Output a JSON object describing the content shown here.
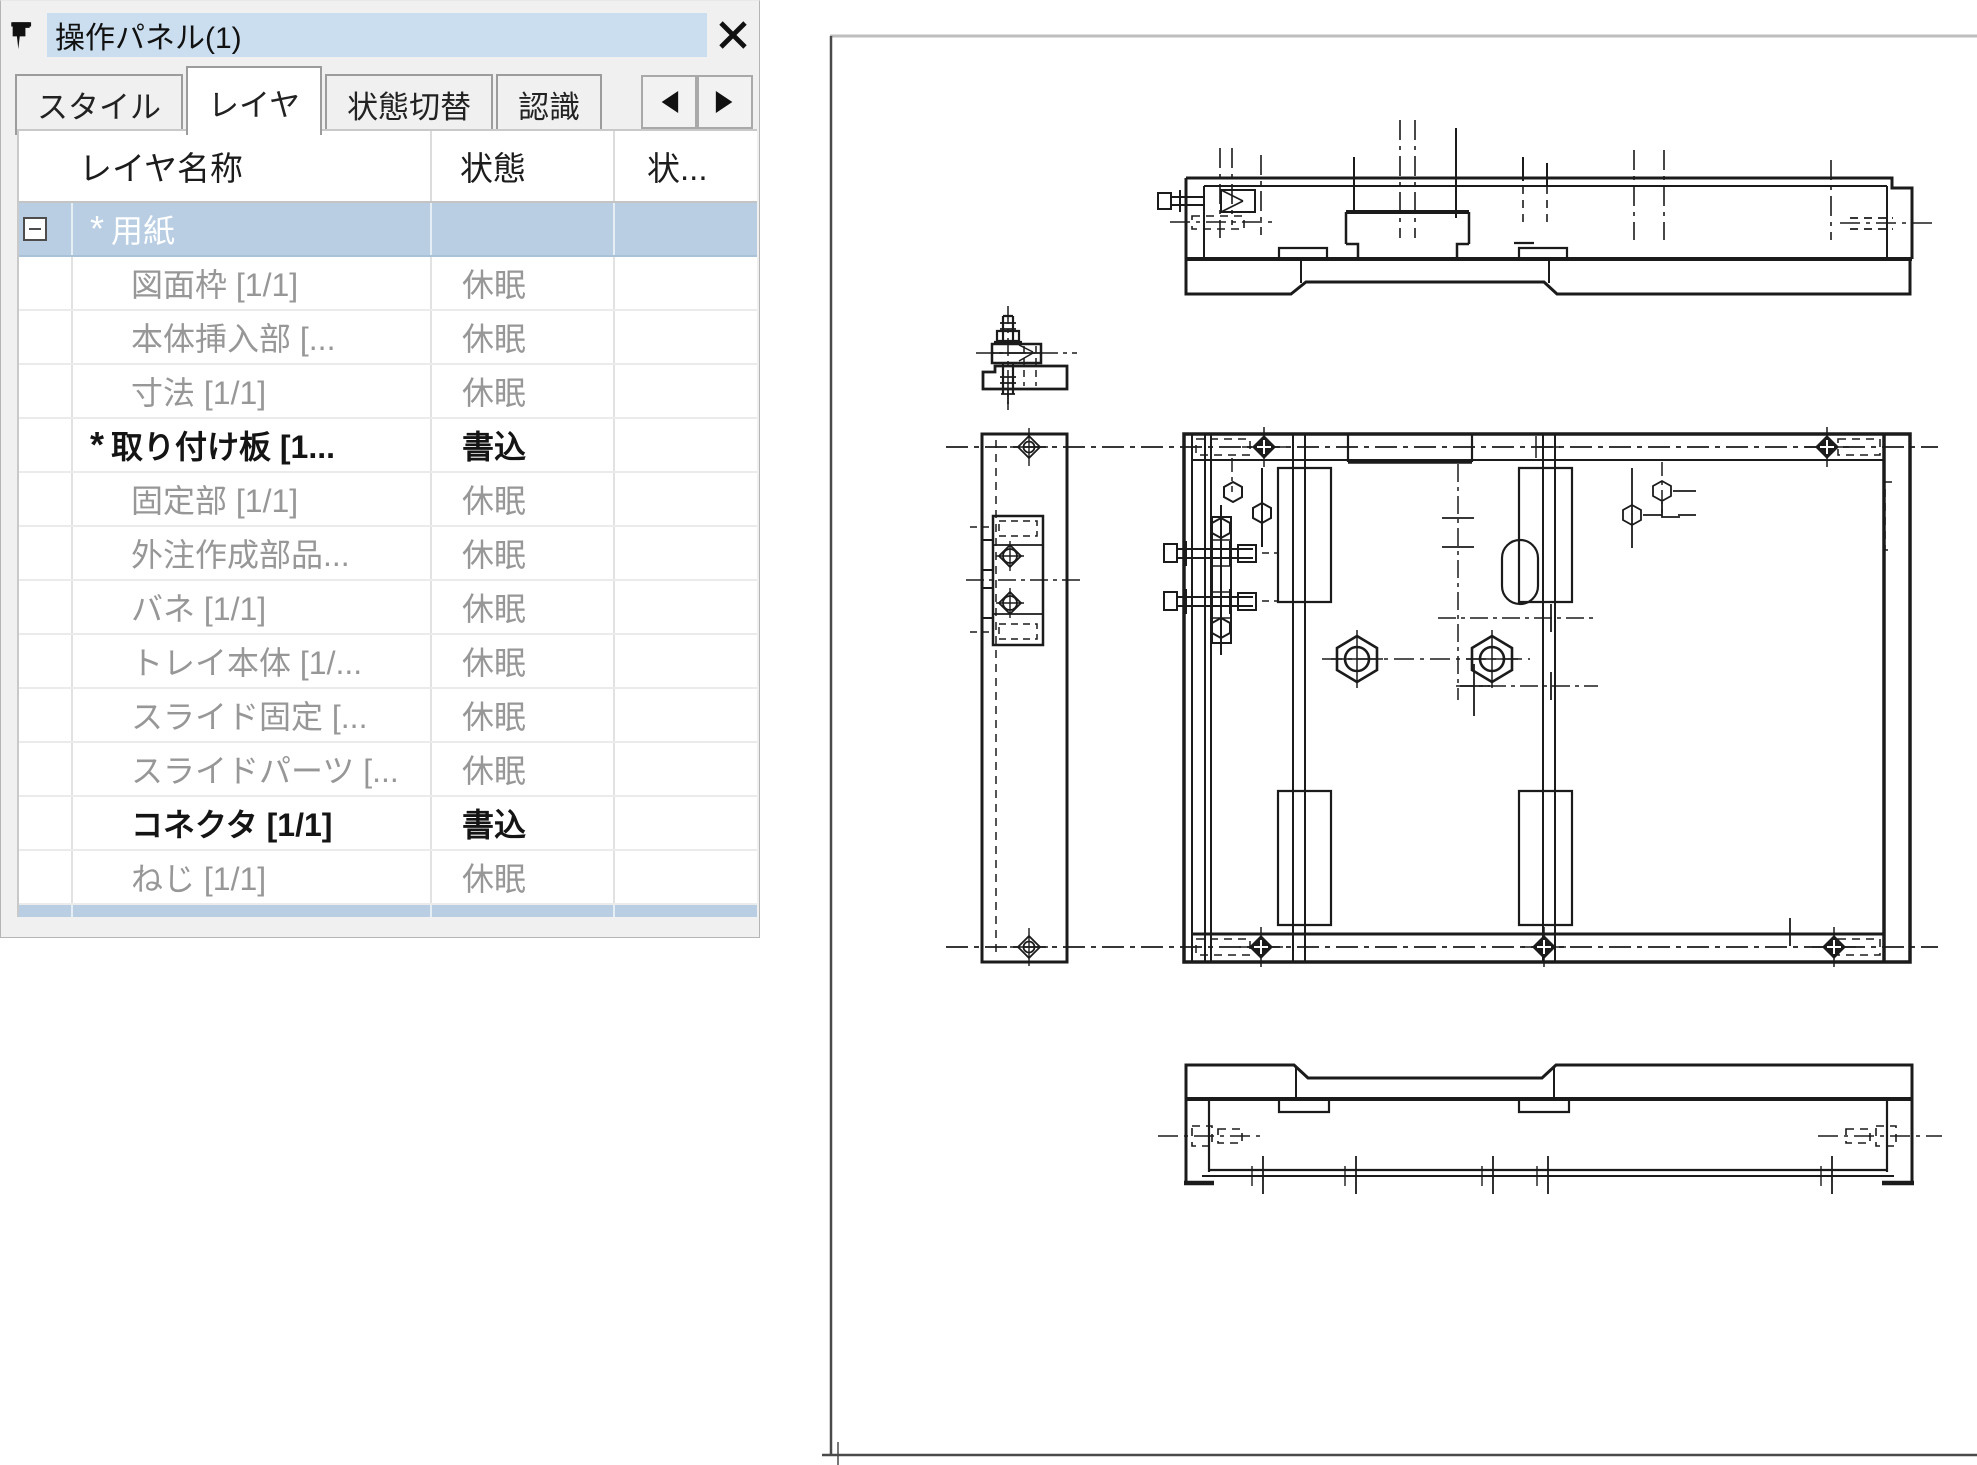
{
  "window": {
    "title": "操作パネル(1)"
  },
  "icons": {
    "pin": "pushpin",
    "close": "✕",
    "scroll_left": "◀",
    "scroll_right": "▶",
    "expand_collapse": "⊟"
  },
  "tabs": [
    {
      "label": "スタイル",
      "active": false
    },
    {
      "label": "レイヤ",
      "active": true
    },
    {
      "label": "状態切替",
      "active": false
    },
    {
      "label": "認識",
      "active": false
    }
  ],
  "table": {
    "columns": [
      "レイヤ名称",
      "状態",
      "状..."
    ],
    "rows": [
      {
        "name": "用紙",
        "prefix": "*",
        "expand": true,
        "status": "",
        "selected": true
      },
      {
        "name": "図面枠 [1/1]",
        "prefix": "",
        "expand": false,
        "status": "休眠",
        "selected": false
      },
      {
        "name": "本体挿入部 [...",
        "prefix": "",
        "expand": false,
        "status": "休眠",
        "selected": false
      },
      {
        "name": "寸法 [1/1]",
        "prefix": "",
        "expand": false,
        "status": "休眠",
        "selected": false
      },
      {
        "name": "取り付け板 [1...",
        "prefix": "*",
        "expand": false,
        "status": "書込",
        "selected": false
      },
      {
        "name": "固定部 [1/1]",
        "prefix": "",
        "expand": false,
        "status": "休眠",
        "selected": false
      },
      {
        "name": "外注作成部品...",
        "prefix": "",
        "expand": false,
        "status": "休眠",
        "selected": false
      },
      {
        "name": "バネ [1/1]",
        "prefix": "",
        "expand": false,
        "status": "休眠",
        "selected": false
      },
      {
        "name": "トレイ本体 [1/...",
        "prefix": "",
        "expand": false,
        "status": "休眠",
        "selected": false
      },
      {
        "name": "スライド固定 [...",
        "prefix": "",
        "expand": false,
        "status": "休眠",
        "selected": false
      },
      {
        "name": "スライドパーツ [...",
        "prefix": "",
        "expand": false,
        "status": "休眠",
        "selected": false
      },
      {
        "name": "コネクタ [1/1]",
        "prefix": "",
        "expand": false,
        "status": "書込",
        "selected": false
      },
      {
        "name": "ねじ [1/1]",
        "prefix": "",
        "expand": false,
        "status": "休眠",
        "selected": false
      }
    ]
  },
  "status_legend": {
    "dormant": "休眠",
    "write": "書込"
  },
  "colors": {
    "titlebar_blue": "#cbdeef",
    "selection_blue": "#b9cee3",
    "dormant_gray": "#979797",
    "written_black": "#141414",
    "drawing_line": "#1b1b1b"
  }
}
